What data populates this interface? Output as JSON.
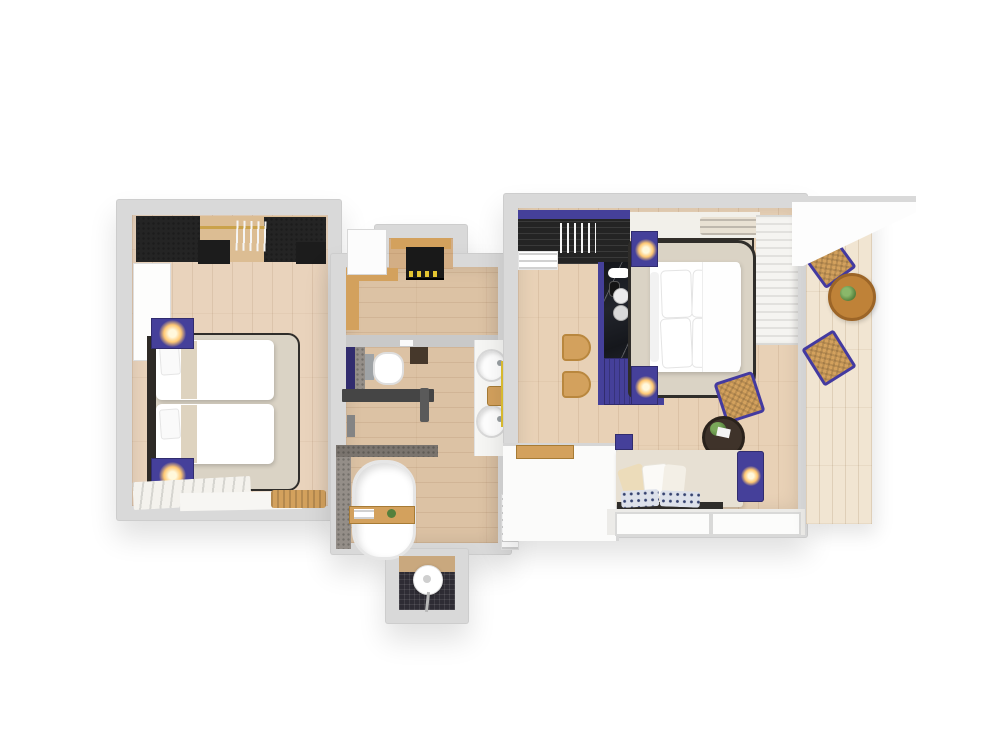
{
  "scene": {
    "title": "Hotel suite 3D floor plan (top-down rendering)",
    "view": "top-down"
  },
  "colors": {
    "wall": "#d9d9d9",
    "wall-edge": "#c9c9c9",
    "floor-a": "#e9d3bc",
    "floor-b": "#dcc2a4",
    "floor-c": "#e8d1b6",
    "deck": "#f1e5d2",
    "dark": "#242424",
    "purple": "#45409a",
    "purple-deep": "#312c6e",
    "marble-base": "#191b20",
    "tan": "#d3a15d",
    "wood": "#bf8238",
    "rug": "#dad3c5",
    "rug-border": "#2f2d2a",
    "tile": "#948e88",
    "tile-dark": "#7a746e",
    "mosaic": "#2e2c34",
    "yellow": "#e3c431",
    "lamp": "#ffc873",
    "green": "#55803c",
    "navy": "#35426f",
    "cream": "#ecdcba",
    "ivory": "#f2f0ea"
  },
  "rooms": [
    {
      "id": "twin-bedroom",
      "name": "Twin Bedroom",
      "furniture": [
        "open wardrobe with hangers and clothes rail",
        "white dresser",
        "twin bed 1",
        "twin bed 2",
        "purple nightstand with lit lamp (top)",
        "purple nightstand with lit lamp (bottom)",
        "area rug with dark border",
        "striped runner rug",
        "floor mat",
        "wooden luggage bench"
      ]
    },
    {
      "id": "hallway",
      "name": "Hallway",
      "furniture": [
        "wooden shelf alcove",
        "dark minibar console with bottles",
        "wooden bench trim",
        "open white door"
      ]
    },
    {
      "id": "bathroom",
      "name": "Bathroom",
      "furniture": [
        "toilet",
        "purple accent wall",
        "tiled wall strip",
        "double vanity counter with two round sinks",
        "wooden stool with amenities",
        "yellow accent strip",
        "glass partition with dark handle",
        "shower valve",
        "dark wooden stool"
      ]
    },
    {
      "id": "bath-area",
      "name": "Bath Area",
      "furniture": [
        "freestanding oval bathtub",
        "wooden bath caddy with towels and plant",
        "towel radiator",
        "rain shower niche with mosaic floor and hand shower"
      ]
    },
    {
      "id": "king-bedroom",
      "name": "King Bedroom",
      "furniture": [
        "open wardrobe with hangers and towel stack",
        "marble console with purple ribbed front and coffee set",
        "two wooden stools",
        "upholstered headboard panel",
        "air-conditioning vent",
        "king bed with four pillows",
        "purple nightstand with lit lamp (top)",
        "purple nightstand with lit lamp (bottom)",
        "area rug with dark border",
        "sheer curtains",
        "rattan chair with purple frame",
        "round side table with plant and book",
        "daybed sofa with cream and patterned cushions",
        "purple ottoman cube",
        "purple side table with lit lamp",
        "entry half-wall with wooden tray",
        "two window sills"
      ]
    },
    {
      "id": "balcony",
      "name": "Balcony",
      "furniture": [
        "wooden deck",
        "white awning overhang",
        "round wooden table with plant",
        "balcony chair with purple frame (top)",
        "balcony chair with purple frame (bottom)"
      ]
    }
  ]
}
